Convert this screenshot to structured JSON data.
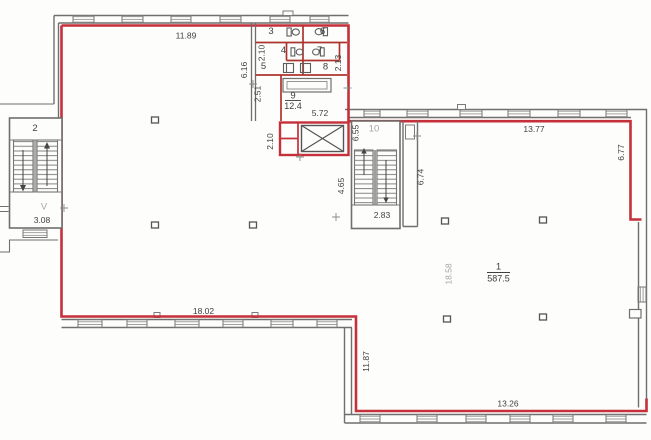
{
  "title": "floor-plan-scan",
  "colors": {
    "boundary_red": "#c5303a",
    "partition_red": "#ad342e",
    "wall_grey": "#6f6f6f",
    "label_dark": "#3f3f3f",
    "label_light_grey": "#a5a5a5",
    "background": "#fdfdfb"
  },
  "rooms": {
    "room1": {
      "number": "1",
      "area": "587.5"
    },
    "room2": {
      "number": "2"
    },
    "room3": {
      "number": "3"
    },
    "room4": {
      "number": "4"
    },
    "room5": {
      "number": "5"
    },
    "room6": {
      "number": "6"
    },
    "room7": {
      "number": "7"
    },
    "room8": {
      "number": "8"
    },
    "room9": {
      "number": "9",
      "area": "12.4"
    },
    "room10": {
      "number": "10"
    }
  },
  "labels": {
    "v_mark": "V"
  },
  "dimensions": {
    "top_left_wall": "11.89",
    "stair2_width": "3.08",
    "toilet_block_height": "6.16",
    "toilet_inner_left": "2.10",
    "toilet_inner_right": "2.13",
    "toilet_lobby": "2.51",
    "toilet_block_width": "5.72",
    "elevator_width": "2.10",
    "stair10_upper": "6.55",
    "stair10_landing": "2.83",
    "stair10_well": "4.65",
    "corridor_height": "6.74",
    "top_right_wall": "13.77",
    "right_wall": "6.77",
    "hall_depth": "18.58",
    "bottom_left_wall": "18.02",
    "step_wall": "11.87",
    "bottom_right_wall": "13.26"
  }
}
